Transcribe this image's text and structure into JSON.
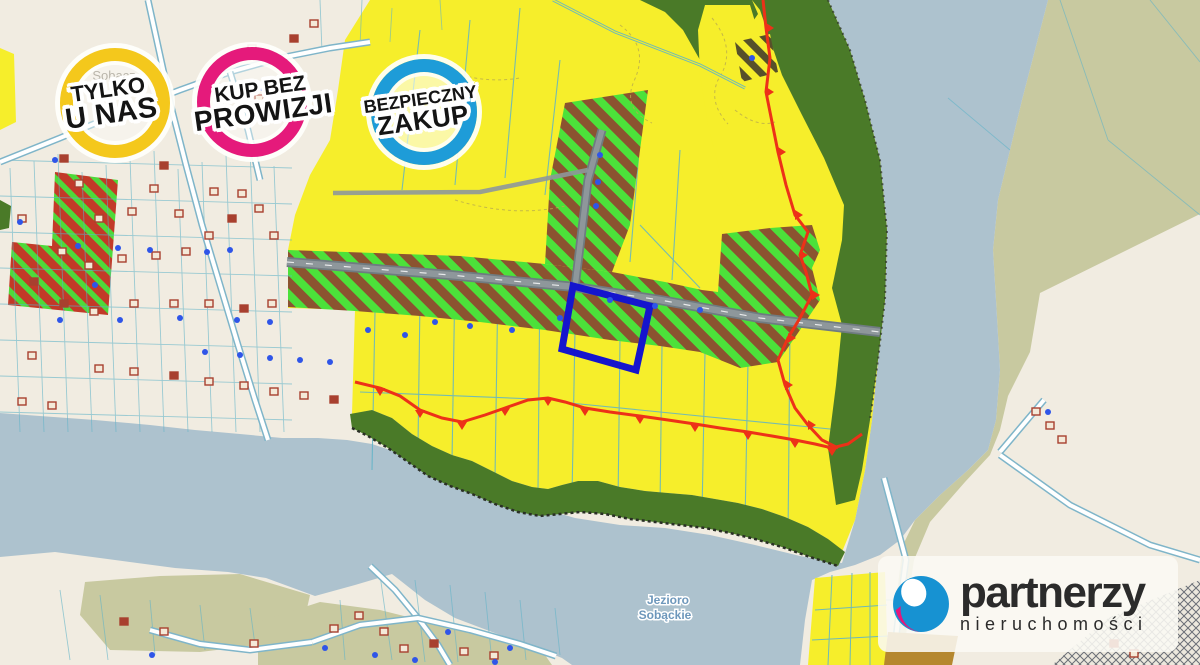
{
  "badges": [
    {
      "id": "tylko-u-nas",
      "line1": "TYLKO",
      "line2": "U NAS",
      "ring_color": "#F4C81C"
    },
    {
      "id": "kup-bez-prowizji",
      "line1": "KUP BEZ",
      "line2": "PROWIZJI",
      "ring_color": "#E51A7B"
    },
    {
      "id": "bezpieczny-zakup",
      "line1": "BEZPIECZNY",
      "line2": "ZAKUP",
      "ring_color": "#1E9CD8"
    }
  ],
  "logo": {
    "title": "partnerzy",
    "subtitle": "nieruchomości"
  },
  "map_labels": {
    "town": "Sobącz",
    "lake_line1": "Jezioro",
    "lake_line2": "Sobąckie"
  },
  "colors": {
    "cream_land": "#F1ECE1",
    "olive_land": "#C8C9A0",
    "water": "#ADC2CE",
    "yellow_zone": "#F6EE2B",
    "green_zone": "#4A7A28",
    "hatch_green": "#4CE13A",
    "hatch_brown": "#8B5330",
    "parcel_red": "#C23A28",
    "parcel_stripe_green": "#4FD93A",
    "dark_hatch": "#57502A",
    "road_gray": "#8E979B",
    "road_casing": "#6F7B81",
    "white_road": "#FFFFFF",
    "white_road_casing": "#7FB5C9",
    "parcel_line": "#5FB3C8",
    "escarpment_red": "#ED3118",
    "highlight_blue": "#1515CD",
    "building_red": "#A8402F",
    "dot_blue": "#2F55E8",
    "badge_yellow": "#F4C81C",
    "badge_pink": "#E51A7B",
    "badge_blue": "#1E9CD8",
    "logo_blue": "#1792D2",
    "logo_pink": "#E5177B",
    "label_gray": "#8A8474",
    "label_lake_blue": "#6D97BB",
    "tan_parcel": "#B5872E"
  }
}
